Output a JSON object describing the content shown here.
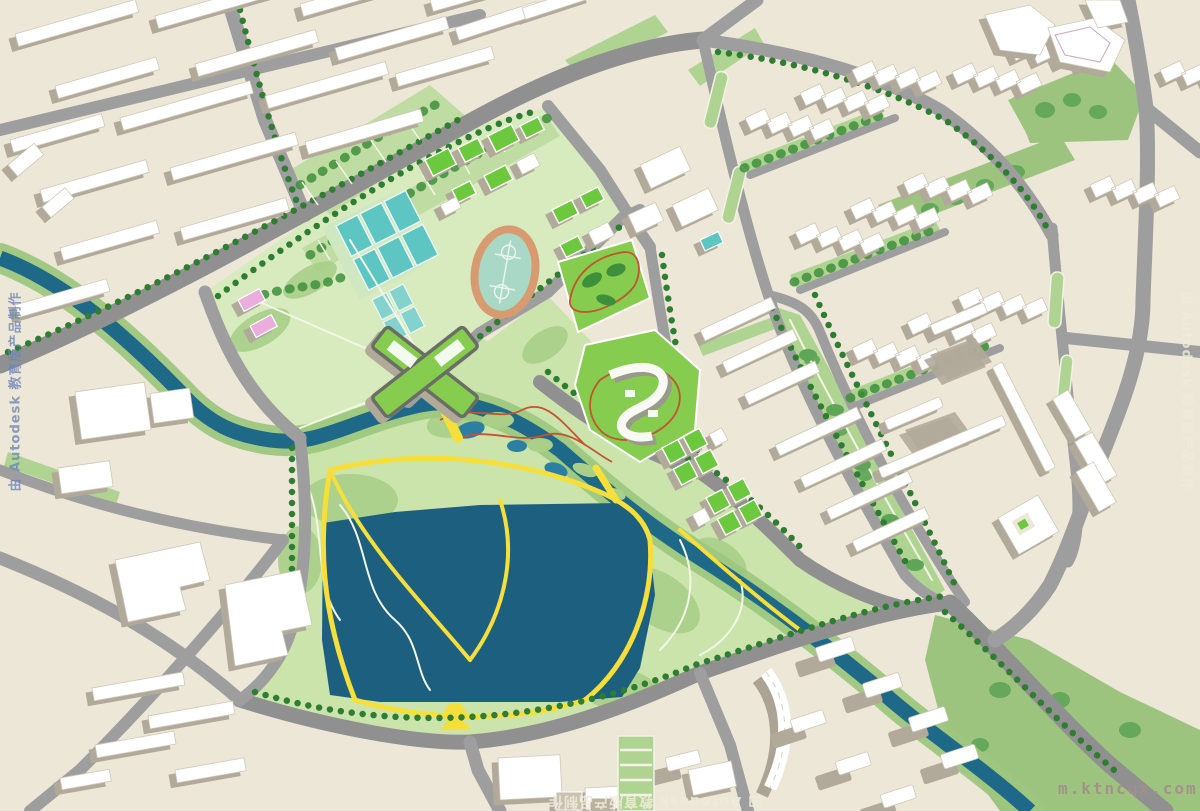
{
  "watermarks": {
    "left": "由 Autodesk 教育版产品制作",
    "right": "由 Autodesk 教育版产品制作",
    "bottom": "由 Autodesk 教育版产品制作",
    "corner": "m.ktncqx.com"
  },
  "palette": {
    "bg": "#EDE7D8",
    "road": "#9E9E9E",
    "roadDark": "#909090",
    "bld": "#FFFFFF",
    "bldEdge": "#CFC8B8",
    "shadow": "#B1AA9A",
    "lawn": "#D8EBBF",
    "park": "#CBE4AC",
    "parkBlob": "#A9CF88",
    "green": "#9CC47F",
    "greenStrip": "#AFD492",
    "hedge": "#BFDCA3",
    "tree": "#2E7D32",
    "treeBlob": "#5FA557",
    "forest": "#3E8F3C",
    "water": "#1E6888",
    "lake": "#1D5F7E",
    "pond": "#2B7FA3",
    "bank": "#9DC77E",
    "courts": "#5EC6C2",
    "courtsLight": "#84D2CD",
    "track": "#D89B6F",
    "infield": "#A9D9C6",
    "groof": "#6CC83C",
    "brightBlock": "#86CC4F",
    "ypath": "#F6DF3A",
    "wpath": "#F2F6E4",
    "rpath": "#C2542F",
    "pink": "#EBAEDC",
    "tan": "#C9C2B0",
    "wmBlue": "#6D87B8",
    "wmLight": "#EFEBDC",
    "wmCorner": "#A48E8C"
  }
}
